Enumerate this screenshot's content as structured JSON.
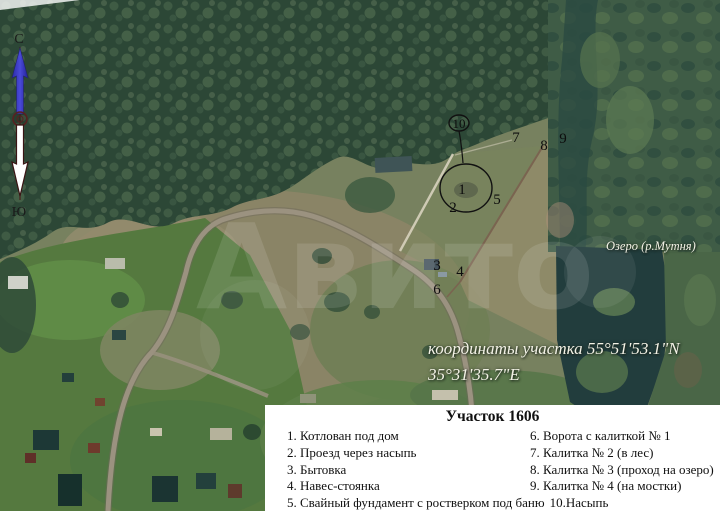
{
  "compass": {
    "north": "С",
    "south": "Ю"
  },
  "map": {
    "watermark": "Авито",
    "lake_label": "Озеро (р.Мутня)",
    "coordinates_line1": "координаты участка 55°51'53.1\"N",
    "coordinates_line2": "35°31'35.7\"E",
    "labels": [
      "1",
      "2",
      "3",
      "4",
      "5",
      "6",
      "7",
      "8",
      "9",
      "10"
    ]
  },
  "legend": {
    "title": "Участок 1606",
    "left_items": [
      "1. Котлован под дом",
      "2. Проезд  через насыпь",
      "3. Бытовка",
      "4. Навес-стоянка"
    ],
    "right_items": [
      "6. Ворота с калиткой № 1",
      "7. Калитка № 2 (в лес)",
      "8. Калитка № 3 (проход на озеро)",
      " 9. Калитка № 4 (на мостки)"
    ],
    "bottom_row": {
      "left": "5. Свайный фундамент с ростверком под баню",
      "right": "10.Насыпь"
    }
  },
  "colors": {
    "forest": "#2c4736",
    "field_tan": "#8b8466",
    "village_green": "#55793f",
    "lake": "#223d3d",
    "road": "#9b9280",
    "legend_bg": "#ffffff",
    "annotation": "#0d0d0d",
    "compass_north_arrow": "#3a3ac0",
    "compass_south_arrow": "#ffffff"
  }
}
